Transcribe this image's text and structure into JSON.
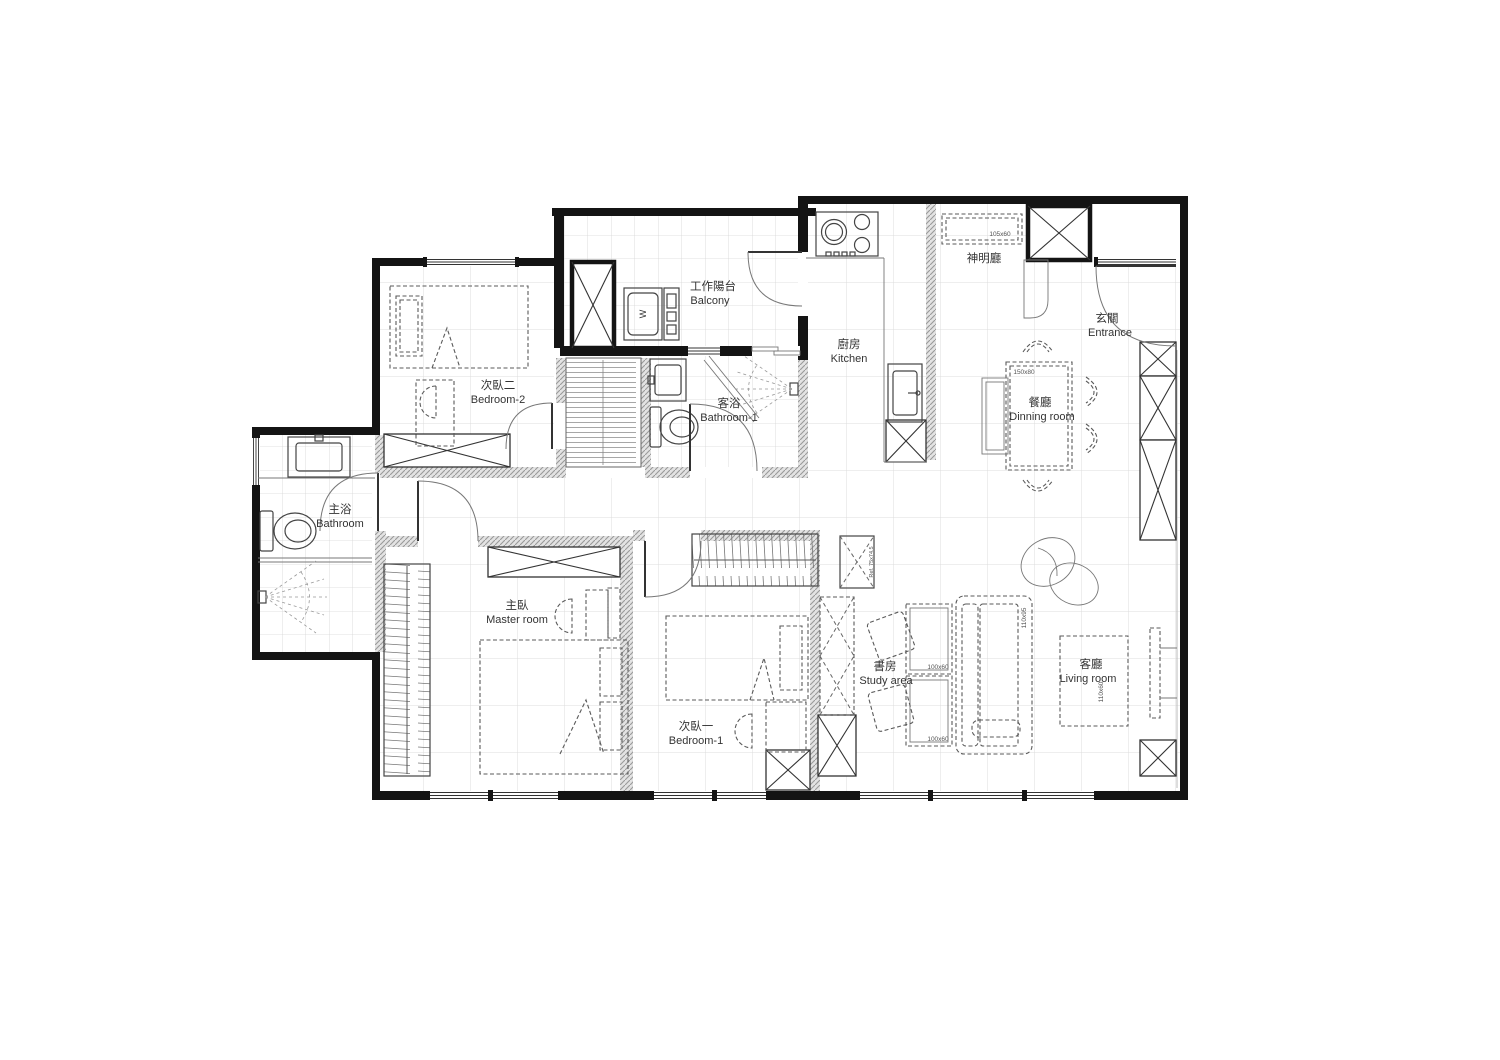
{
  "plan": {
    "rooms": {
      "balcony": {
        "zh": "工作陽台",
        "en": "Balcony"
      },
      "bedroom2": {
        "zh": "次臥二",
        "en": "Bedroom-2"
      },
      "kitchen": {
        "zh": "廚房",
        "en": "Kitchen"
      },
      "bathroom1": {
        "zh": "客浴",
        "en": "Bathroom-1"
      },
      "shrine": {
        "zh": "神明廳"
      },
      "entrance": {
        "zh": "玄關",
        "en": "Entrance"
      },
      "dining": {
        "zh": "餐廳",
        "en": "Dinning room"
      },
      "master_bath": {
        "zh": "主浴",
        "en": "Bathroom"
      },
      "master": {
        "zh": "主臥",
        "en": "Master room"
      },
      "bedroom1": {
        "zh": "次臥一",
        "en": "Bedroom-1"
      },
      "study": {
        "zh": "書房",
        "en": "Study area"
      },
      "living": {
        "zh": "客廳",
        "en": "Living room"
      }
    },
    "labels": {
      "washer": "W",
      "altar_dim": "105x60",
      "dining_table_dim": "150x80",
      "desk_dim": "100x60",
      "tv_console_dim": "110x60",
      "sofa_dim": "110x95",
      "fridge_dim": "Ref. 75x74.5"
    },
    "colors": {
      "wall": "#141414",
      "hatch": "#9a9a9a",
      "grid": "#dcdcdc",
      "furniture": "#5a5a5a"
    }
  }
}
